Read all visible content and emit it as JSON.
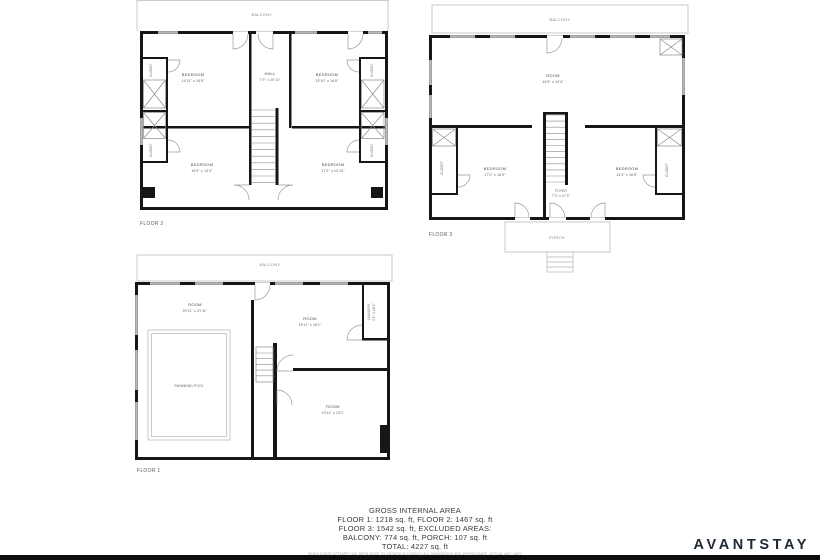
{
  "meta": {
    "brand": "AVANTSTAY"
  },
  "summary": {
    "title": "GROSS INTERNAL AREA",
    "line1": "FLOOR 1: 1218 sq. ft, FLOOR 2: 1467 sq. ft",
    "line2": "FLOOR 3: 1542 sq. ft, EXCLUDED AREAS:",
    "line3": "BALCONY: 774 sq. ft, PORCH: 107 sq. ft",
    "line4": "TOTAL: 4227 sq. ft",
    "disclaimer": "WHILE EVERY ATTEMPT HAS BEEN MADE TO ENSURE ACCURACY, ALL DIMENSIONS ARE APPROXIMATE, ACTUAL MAY VARY"
  },
  "floor2": {
    "label": "FLOOR 2",
    "balcony": "BALCONY",
    "rooms": {
      "bedroom_tl": {
        "name": "BEDROOM",
        "dims": "14'11\" x 16'8\""
      },
      "hall": {
        "name": "HALL",
        "dims": "7'9\" x 20'11\""
      },
      "bedroom_tr": {
        "name": "BEDROOM",
        "dims": "13'10\" x 16'6\""
      },
      "bedroom_bl": {
        "name": "BEDROOM",
        "dims": "16'9\" x 13'3\""
      },
      "bedroom_br": {
        "name": "BEDROOM",
        "dims": "17'2\" x 13'10\""
      },
      "closet_lt": {
        "name": "CLOSET",
        "dims": "4'6\" x 9'2\""
      },
      "closet_lb": {
        "name": "CLOSET",
        "dims": "4'6\" x 9'2\""
      },
      "closet_rt": {
        "name": "CLOSET",
        "dims": "4'6\" x 9'2\""
      },
      "closet_rb": {
        "name": "CLOSET",
        "dims": "4'6\" x 9'2\""
      }
    }
  },
  "floor3": {
    "label": "FLOOR 3",
    "balcony": "BALCONY",
    "porch": "PORCH",
    "rooms": {
      "room": {
        "name": "ROOM",
        "dims": "46'8\" x 24'4\""
      },
      "bedroom_l": {
        "name": "BEDROOM",
        "dims": "17'0\" x 16'5\""
      },
      "foyer": {
        "name": "FOYER",
        "dims": "7'3\" x 17'0\""
      },
      "bedroom_r": {
        "name": "BEDROOM",
        "dims": "14'3\" x 16'8\""
      },
      "closet_l": {
        "name": "CLOSET",
        "dims": "4'1\" x 10'2\""
      },
      "closet_r": {
        "name": "CLOSET",
        "dims": "4'1\" x 10'2\""
      }
    }
  },
  "floor1": {
    "label": "FLOOR 1",
    "balcony": "BALCONY",
    "rooms": {
      "room_l": {
        "name": "ROOM",
        "dims": "29'11\" x 21'11\""
      },
      "pool": {
        "name": "SWIMMING POOL"
      },
      "room_tr": {
        "name": "ROOM",
        "dims": "19'11\" x 16'1\""
      },
      "laundry": {
        "name": "LAUNDRY",
        "dims": "4'1\" x 16'4\""
      },
      "room_br": {
        "name": "ROOM",
        "dims": "19'11\" x 13'1\""
      }
    }
  }
}
